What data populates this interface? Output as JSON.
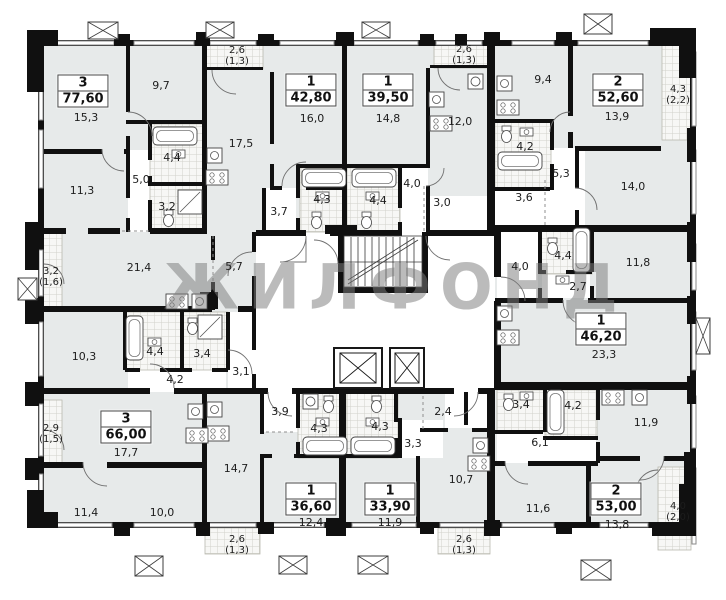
{
  "watermark": "ЖИЛФОНД",
  "colors": {
    "room_fill": "#e7eaea",
    "wall": "#101010",
    "wet_area_fill": "#f7f7f5",
    "watermark_gray": "#7d7d7d"
  },
  "apartments": [
    {
      "id": "apt-3-77-60",
      "type_label": "3",
      "area_label": "77,60",
      "rooms": [
        "15,3",
        "9,7",
        "11,3",
        "4,4",
        "5,0",
        "3,2",
        "21,4",
        "5,7"
      ],
      "balcony": [
        "3,2",
        "(1,6)"
      ]
    },
    {
      "id": "apt-1-42-80",
      "type_label": "1",
      "area_label": "42,80",
      "rooms": [
        "16,0",
        "17,5",
        "3,7",
        "4,3"
      ],
      "balcony": [
        "2,6",
        "(1,3)"
      ]
    },
    {
      "id": "apt-1-39-50",
      "type_label": "1",
      "area_label": "39,50",
      "rooms": [
        "14,8",
        "12,0",
        "4,4",
        "4,0",
        "3,0"
      ],
      "balcony": [
        "2,6",
        "(1,3)"
      ]
    },
    {
      "id": "apt-2-52-60",
      "type_label": "2",
      "area_label": "52,60",
      "rooms": [
        "9,4",
        "13,9",
        "4,2",
        "5,3",
        "3,6",
        "14,0"
      ],
      "balcony": [
        "4,3",
        "(2,2)"
      ]
    },
    {
      "id": "apt-1-46-20",
      "type_label": "1",
      "area_label": "46,20",
      "rooms": [
        "23,3",
        "11,8",
        "4,0",
        "4,4",
        "2,7"
      ],
      "balcony": null
    },
    {
      "id": "apt-3-66-00",
      "type_label": "3",
      "area_label": "66,00",
      "rooms": [
        "17,7",
        "11,4",
        "10,0",
        "10,3",
        "4,4",
        "3,4",
        "4,2",
        "3,1"
      ],
      "balcony": [
        "2,9",
        "(1,5)"
      ]
    },
    {
      "id": "apt-1-36-60",
      "type_label": "1",
      "area_label": "36,60",
      "rooms": [
        "12,4",
        "14,7",
        "3,9",
        "4,3"
      ],
      "balcony": [
        "2,6",
        "(1,3)"
      ]
    },
    {
      "id": "apt-1-33-90",
      "type_label": "1",
      "area_label": "33,90",
      "rooms": [
        "11,9",
        "10,7",
        "4,3",
        "3,3",
        "2,4"
      ],
      "balcony": [
        "2,6",
        "(1,3)"
      ]
    },
    {
      "id": "apt-2-53-00",
      "type_label": "2",
      "area_label": "53,00",
      "rooms": [
        "13,8",
        "11,6",
        "11,9",
        "6,1",
        "3,4",
        "4,2"
      ],
      "balcony": [
        "4,0",
        "(2,0)"
      ]
    }
  ]
}
